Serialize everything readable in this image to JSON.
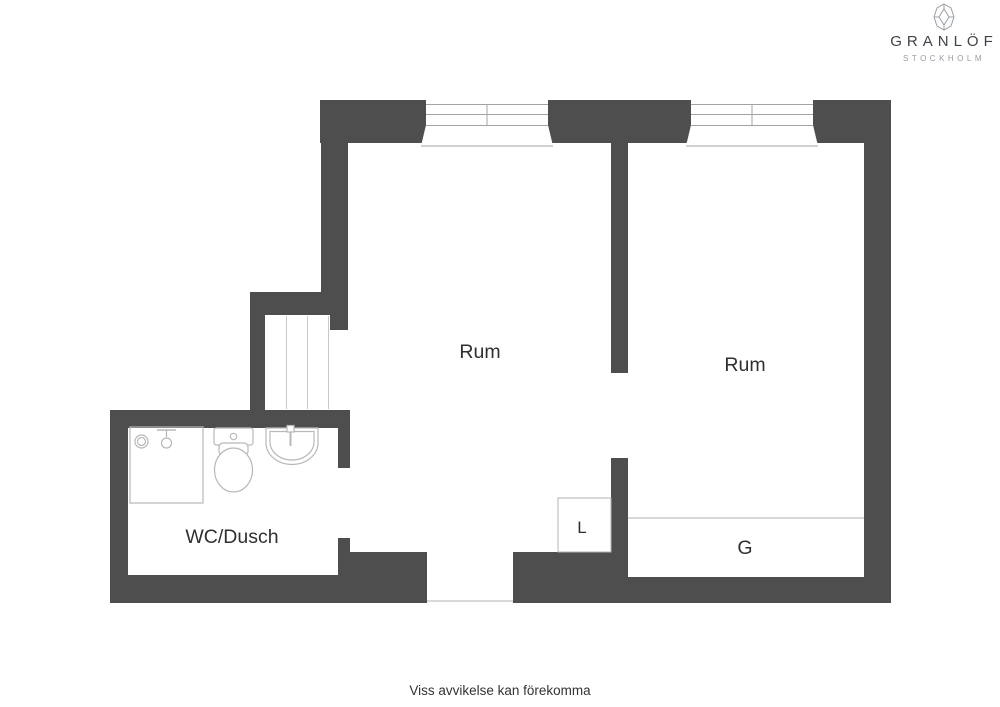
{
  "branding": {
    "name": "GRANLÖF",
    "city": "STOCKHOLM"
  },
  "floorplan": {
    "rooms": [
      {
        "id": "room-left",
        "label": "Rum"
      },
      {
        "id": "room-right",
        "label": "Rum"
      },
      {
        "id": "bathroom",
        "label": "WC/Dusch"
      },
      {
        "id": "closet-linen",
        "label": "L"
      },
      {
        "id": "closet-wardrobe",
        "label": "G"
      }
    ],
    "colors": {
      "wall": "#4e4e4e",
      "fixture_line": "#b8b8b8",
      "text": "#2f2f2f"
    }
  },
  "footer": {
    "disclaimer": "Viss avvikelse kan förekomma"
  }
}
